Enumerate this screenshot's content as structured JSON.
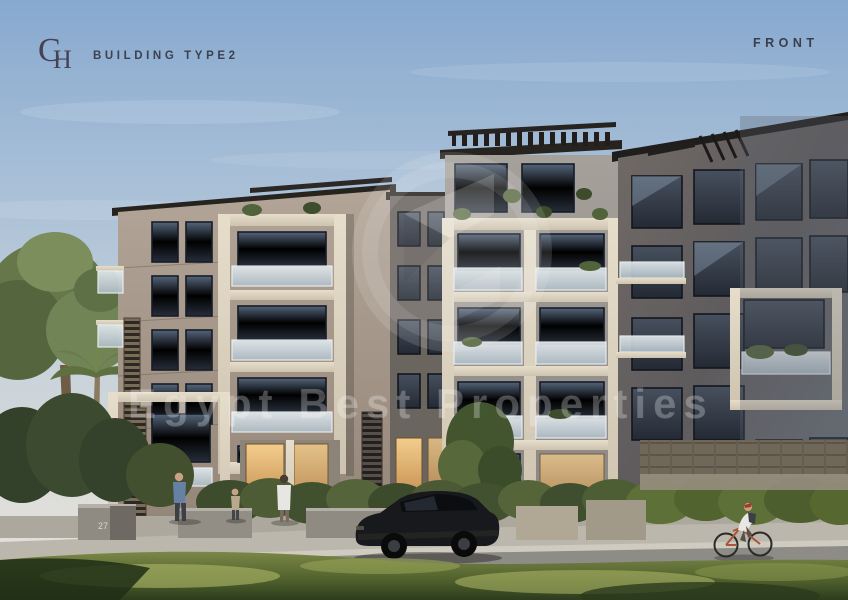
{
  "header": {
    "logo_monogram": "CH",
    "logo_letter_c": "C",
    "logo_letter_h": "H",
    "title": "BUILDING TYPE2",
    "view_label": "FRONT"
  },
  "watermark": {
    "text": "Egypt Best Properties"
  },
  "scene": {
    "planter_number": "27"
  },
  "colors": {
    "sky_top": "#87a9cf",
    "sky_horizon": "#e6e1d8",
    "label_text": "#3d4150",
    "facade_taupe": "#a89a8c",
    "facade_cream": "#ddd4c2",
    "facade_gray": "#9a9793",
    "facade_dark": "#5f5c5c",
    "window_glass": "#333b47",
    "lit_window": "#e9c27f",
    "grass_sunlit": "#9aa65c",
    "grass_shadow": "#2e3e1c",
    "watermark_white_opacity": "0.21"
  }
}
